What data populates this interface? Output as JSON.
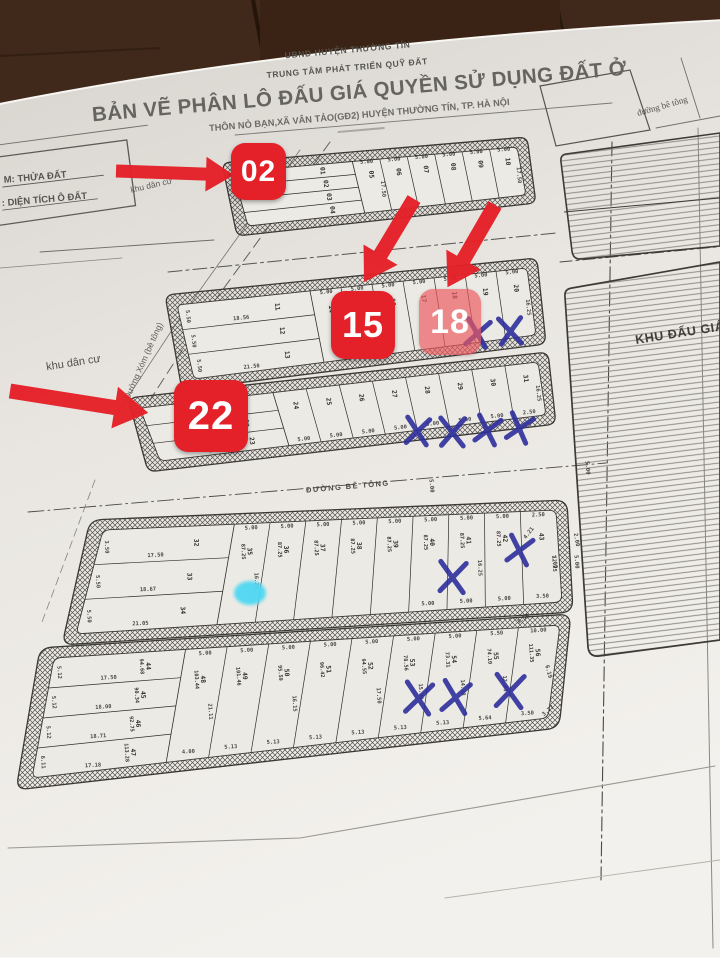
{
  "colors": {
    "wood": "#40281a",
    "wood_dark": "#2a1a0e",
    "paper_top": "#d7d4ce",
    "paper_mid": "#e9e6e1",
    "paper_bottom": "#f3f1ed",
    "ink": "#3c3b38",
    "annotation_red": "#e42028",
    "annotation_blue": "#2e2f9b",
    "dot_cyan": "#4fd8f3"
  },
  "header": {
    "org1": "UBND HUYỆN THƯỜNG TÍN",
    "org2": "TRUNG TÂM PHÁT TRIỂN QUỸ ĐẤT",
    "title": "BẢN VẼ PHÂN LÔ ĐẤU GIÁ QUYỀN SỬ DỤNG ĐẤT Ở",
    "subtitle": "THÔN NỎ BẠN,XÃ VÂN TẢO(GĐ2) HUYỆN THƯỜNG TÍN, TP. HÀ NỘI"
  },
  "legend": {
    "line1": "M: THỬA ĐẤT",
    "line2": ": DIỆN TÍCH Ô ĐẤT"
  },
  "labels": {
    "khu_dan_cu_top": "khu dân cư",
    "khu_dan_cu_left": "khu dân cư",
    "duong_xom": "Đường Xóm (bê tông)",
    "duong_be_tong_mid": "ĐƯỜNG BÊ TÔNG",
    "duong_be_tong_topright": "đường bê tông",
    "khu_dau_gia": "KHU ĐẤU GIÁ"
  },
  "annotations": {
    "plot_labels": [
      {
        "text": "02",
        "x": 231,
        "y": 143,
        "w": 55,
        "h": 57,
        "solid": true,
        "fs": 30
      },
      {
        "text": "15",
        "x": 331,
        "y": 291,
        "w": 64,
        "h": 68,
        "solid": true,
        "fs": 36
      },
      {
        "text": "18",
        "x": 419,
        "y": 289,
        "w": 62,
        "h": 66,
        "solid": false,
        "fs": 34
      },
      {
        "text": "22",
        "x": 174,
        "y": 380,
        "w": 74,
        "h": 72,
        "solid": true,
        "fs": 40
      }
    ],
    "arrows": [
      {
        "x": 116,
        "y": 171,
        "len": 118,
        "ang": 2,
        "w": 13,
        "head": 28
      },
      {
        "x": 414,
        "y": 199,
        "len": 97,
        "ang": 121,
        "w": 15,
        "head": 32
      },
      {
        "x": 495,
        "y": 205,
        "len": 95,
        "ang": 120,
        "w": 15,
        "head": 32
      },
      {
        "x": 10,
        "y": 391,
        "len": 140,
        "ang": 9,
        "w": 15,
        "head": 34
      }
    ],
    "x_marks": [
      {
        "x": 477,
        "y": 333,
        "s": 13,
        "r": 8
      },
      {
        "x": 510,
        "y": 331,
        "s": 13,
        "r": -5
      },
      {
        "x": 417,
        "y": 431,
        "s": 13,
        "r": 5
      },
      {
        "x": 452,
        "y": 432,
        "s": 14,
        "r": 0
      },
      {
        "x": 487,
        "y": 430,
        "s": 13,
        "r": 12
      },
      {
        "x": 519,
        "y": 428,
        "s": 13,
        "r": 15
      },
      {
        "x": 452,
        "y": 577,
        "s": 15,
        "r": 3
      },
      {
        "x": 519,
        "y": 550,
        "s": 13,
        "r": 12
      },
      {
        "x": 418,
        "y": 698,
        "s": 15,
        "r": 5
      },
      {
        "x": 455,
        "y": 697,
        "s": 15,
        "r": 8
      },
      {
        "x": 509,
        "y": 691,
        "s": 16,
        "r": 3
      }
    ],
    "dot": {
      "x": 250,
      "y": 593,
      "rx": 16,
      "ry": 12
    }
  },
  "map": {
    "blocks": [
      {
        "id": "B1",
        "outer": [
          [
            222,
            163
          ],
          [
            527,
            137
          ],
          [
            536,
            203
          ],
          [
            237,
            236
          ]
        ],
        "inner": [
          [
            233,
            172
          ],
          [
            517,
            147
          ],
          [
            526,
            195
          ],
          [
            248,
            226
          ]
        ],
        "r": 8,
        "fx": 0.42,
        "rows": [
          {
            "no": "01"
          },
          {
            "no": "02"
          },
          {
            "no": "03"
          },
          {
            "no": "04"
          }
        ],
        "cols": [
          {
            "no": "05",
            "wt": "5.00",
            "h": "17.50"
          },
          {
            "no": "06",
            "wt": "5.00"
          },
          {
            "no": "07",
            "wt": "5.00"
          },
          {
            "no": "08",
            "wt": "5.00"
          },
          {
            "no": "09",
            "wt": "5.00"
          },
          {
            "no": "10",
            "wt": "5.00",
            "h": "17.50"
          }
        ]
      },
      {
        "id": "B2",
        "outer": [
          [
            165,
            295
          ],
          [
            537,
            258
          ],
          [
            546,
            344
          ],
          [
            182,
            390
          ]
        ],
        "inner": [
          [
            177,
            305
          ],
          [
            527,
            268
          ],
          [
            536,
            335
          ],
          [
            194,
            379
          ]
        ],
        "r": 9,
        "fx": 0.38,
        "rows": [
          {
            "no": "11",
            "w": "18.56",
            "h": "5.50"
          },
          {
            "no": "12",
            "h": "5.50"
          },
          {
            "no": "13",
            "w": "21.50",
            "h": "5.50"
          }
        ],
        "cols": [
          {
            "no": "14",
            "wt": "5.00"
          },
          {
            "no": "15",
            "wt": "5.00"
          },
          {
            "no": "16",
            "wt": "5.00"
          },
          {
            "no": "17",
            "wt": "5.00"
          },
          {
            "no": "18",
            "wt": "5.00"
          },
          {
            "no": "19",
            "wt": "5.00"
          },
          {
            "no": "20",
            "wt": "5.00",
            "h": "16.25"
          }
        ]
      },
      {
        "id": "B3",
        "outer": [
          [
            128,
            398
          ],
          [
            548,
            352
          ],
          [
            556,
            424
          ],
          [
            148,
            472
          ]
        ],
        "inner": [
          [
            140,
            408
          ],
          [
            538,
            362
          ],
          [
            546,
            415
          ],
          [
            160,
            461
          ]
        ],
        "r": 9,
        "fx": 0.334,
        "rows": [
          {
            "no": "21"
          },
          {
            "no": "22"
          },
          {
            "no": "23",
            "w": "17.51"
          }
        ],
        "cols": [
          {
            "no": "24",
            "wb": "5.00"
          },
          {
            "no": "25",
            "wb": "5.00"
          },
          {
            "no": "26",
            "wb": "5.00"
          },
          {
            "no": "27",
            "wb": "5.00"
          },
          {
            "no": "28",
            "wb": "5.00"
          },
          {
            "no": "29",
            "wb": "5.00"
          },
          {
            "no": "30",
            "wb": "5.00"
          },
          {
            "no": "31",
            "wb": "2.50",
            "h": "16.25"
          }
        ]
      },
      {
        "id": "B4",
        "outer": [
          [
            90,
            520
          ],
          [
            567,
            500
          ],
          [
            573,
            612
          ],
          [
            62,
            645
          ]
        ],
        "inner": [
          [
            103,
            530
          ],
          [
            556,
            510
          ],
          [
            562,
            602
          ],
          [
            76,
            634
          ]
        ],
        "r": 12,
        "fx": 0.29,
        "rows": [
          {
            "no": "32",
            "w": "17.50",
            "h": "3.50"
          },
          {
            "no": "33",
            "w": "18.67",
            "h": "5.50"
          },
          {
            "no": "34",
            "w": "21.05",
            "h": "5.50"
          }
        ],
        "cols": [
          {
            "no": "35",
            "a": "87.25",
            "wt": "5.00",
            "h": "16.25"
          },
          {
            "no": "36",
            "a": "87.25",
            "wt": "5.00"
          },
          {
            "no": "37",
            "a": "87.25",
            "wt": "5.00"
          },
          {
            "no": "38",
            "a": "87.25",
            "wt": "5.00"
          },
          {
            "no": "39",
            "a": "87.25",
            "wt": "5.00"
          },
          {
            "no": "40",
            "a": "87.25",
            "wt": "5.00",
            "wb": "5.00"
          },
          {
            "no": "41",
            "a": "87.25",
            "wt": "5.00",
            "wb": "5.00",
            "h": "16.25"
          },
          {
            "no": "42",
            "a": "87.25",
            "wt": "5.00",
            "wb": "5.00"
          },
          {
            "no": "43",
            "wt": "2.50",
            "wb": "3.50",
            "h": "12.25"
          }
        ]
      },
      {
        "id": "B5",
        "outer": [
          [
            40,
            648
          ],
          [
            571,
            614
          ],
          [
            559,
            728
          ],
          [
            16,
            790
          ]
        ],
        "inner": [
          [
            54,
            658
          ],
          [
            560,
            625
          ],
          [
            548,
            718
          ],
          [
            32,
            778
          ]
        ],
        "r": 12,
        "fx": 0.26,
        "rows": [
          {
            "no": "44",
            "a": "94.68",
            "w": "17.50",
            "h": "5.12"
          },
          {
            "no": "45",
            "a": "90.34",
            "w": "18.00",
            "h": "5.12"
          },
          {
            "no": "46",
            "a": "92.75",
            "w": "18.71",
            "h": "5.12"
          },
          {
            "no": "47",
            "a": "113.28",
            "w": "17.18",
            "h": "6.11"
          }
        ],
        "cols": [
          {
            "no": "48",
            "a": "103.44",
            "wt": "5.00",
            "wb": "4.00",
            "h": "21.11"
          },
          {
            "no": "49",
            "a": "101.46",
            "wt": "5.00",
            "wb": "5.13"
          },
          {
            "no": "50",
            "a": "95.59",
            "wt": "5.00",
            "wb": "5.13",
            "h": "16.15"
          },
          {
            "no": "51",
            "a": "96.42",
            "wt": "5.00",
            "wb": "5.13"
          },
          {
            "no": "52",
            "a": "94.55",
            "wt": "5.00",
            "wb": "5.13",
            "h": "17.50"
          },
          {
            "no": "53",
            "a": "78.56",
            "wt": "5.00",
            "wb": "5.13",
            "h": "15.29"
          },
          {
            "no": "54",
            "a": "73.31",
            "wt": "5.00",
            "wb": "5.13",
            "h": "14.18"
          },
          {
            "no": "55",
            "a": "74.10",
            "wt": "5.50",
            "wb": "5.64",
            "h": "12.05"
          },
          {
            "no": "56",
            "a": "111.35",
            "wt": "10.00",
            "wb": "3.50"
          }
        ]
      }
    ],
    "loose_dims": [
      {
        "t": "5.00",
        "x": 586,
        "y": 468,
        "r": 85
      },
      {
        "t": "4.21",
        "x": 530,
        "y": 534,
        "r": -52
      },
      {
        "t": "2.00",
        "x": 575,
        "y": 540,
        "r": 80
      },
      {
        "t": "7.00",
        "x": 553,
        "y": 562,
        "r": 80
      },
      {
        "t": "5.00",
        "x": 575,
        "y": 562,
        "r": 85
      },
      {
        "t": "3.50",
        "x": 524,
        "y": 620,
        "r": -35
      },
      {
        "t": "6.19",
        "x": 547,
        "y": 672,
        "r": 75
      },
      {
        "t": "3.77",
        "x": 549,
        "y": 712,
        "r": -40
      },
      {
        "t": "5.00",
        "x": 430,
        "y": 486,
        "r": 85
      }
    ]
  }
}
